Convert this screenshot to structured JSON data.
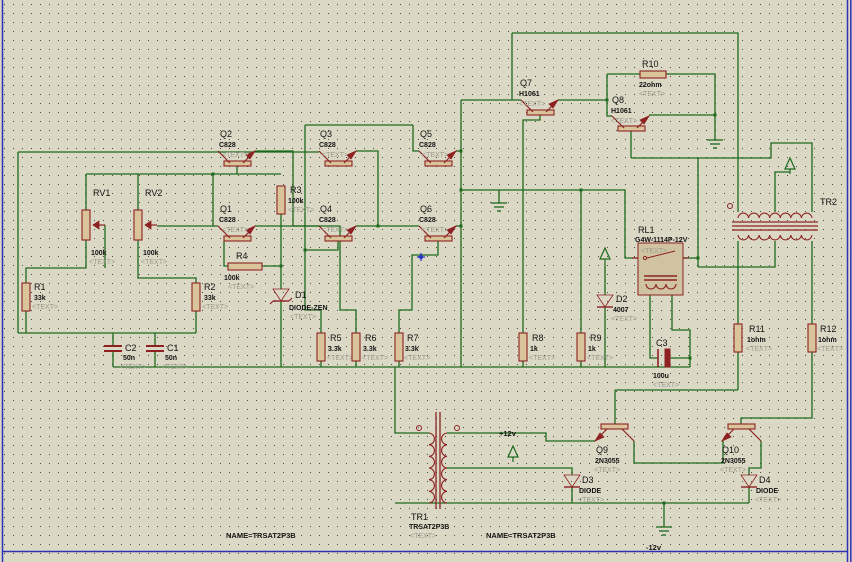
{
  "app": {
    "title": "ISIS Schematic Capture - inverter circuit sheet"
  },
  "canvas": {
    "width": 852,
    "height": 562,
    "bg_color": "#dbd8c6",
    "dot_color": "#4a493c",
    "border_color": "#3030b4",
    "wire_color": "#1d6a1d",
    "part_color": "#8e2222",
    "part_fill": "#d9c49c",
    "relay_fill": "#cfc3a2",
    "placeholder_color": "#9b9b8d"
  },
  "components": [
    {
      "type": "res_v",
      "ref": "R1",
      "value": "33k",
      "extra": "<TEXT>",
      "x": 26,
      "y": 283,
      "label_pos": [
        [
          34,
          290
        ],
        [
          34,
          300
        ],
        [
          32,
          309
        ]
      ]
    },
    {
      "type": "res_v",
      "ref": "R2",
      "value": "33k",
      "extra": "<TEXT>",
      "x": 196,
      "y": 283,
      "label_pos": [
        [
          204,
          290
        ],
        [
          204,
          300
        ],
        [
          202,
          309
        ]
      ]
    },
    {
      "type": "res_v",
      "ref": "R3",
      "value": "100k",
      "extra": "<TEXT>",
      "x": 281,
      "y": 186,
      "label_pos": [
        [
          290,
          193
        ],
        [
          288,
          203
        ],
        [
          288,
          212
        ]
      ]
    },
    {
      "type": "res_h",
      "ref": "R4",
      "value": "100k",
      "extra": "<TEXT>",
      "x": 228,
      "y": 263,
      "w": 34,
      "label_pos": [
        [
          236,
          259
        ],
        [
          224,
          280
        ],
        [
          228,
          289
        ]
      ]
    },
    {
      "type": "res_v",
      "ref": "R5",
      "value": "3.3k",
      "extra": "<TEXT>",
      "x": 321,
      "y": 333,
      "label_pos": [
        [
          330,
          341
        ],
        [
          328,
          351
        ],
        [
          327,
          360
        ]
      ]
    },
    {
      "type": "res_v",
      "ref": "R6",
      "value": "3.3k",
      "extra": "<TEXT>",
      "x": 356,
      "y": 333,
      "label_pos": [
        [
          365,
          341
        ],
        [
          363,
          351
        ],
        [
          362,
          360
        ]
      ]
    },
    {
      "type": "res_v",
      "ref": "R7",
      "value": "3.3k",
      "extra": "<TEXT>",
      "x": 399,
      "y": 333,
      "label_pos": [
        [
          407,
          341
        ],
        [
          405,
          351
        ],
        [
          404,
          360
        ]
      ]
    },
    {
      "type": "res_v",
      "ref": "R8",
      "value": "1k",
      "extra": "<TEXT>",
      "x": 523,
      "y": 333,
      "label_pos": [
        [
          532,
          341
        ],
        [
          530,
          351
        ],
        [
          529,
          360
        ]
      ]
    },
    {
      "type": "res_v",
      "ref": "R9",
      "value": "1k",
      "extra": "<TEXT>",
      "x": 581,
      "y": 333,
      "label_pos": [
        [
          590,
          341
        ],
        [
          588,
          351
        ],
        [
          587,
          360
        ]
      ]
    },
    {
      "type": "res_h",
      "ref": "R10",
      "value": "22ohm",
      "extra": "<TEXT>",
      "x": 640,
      "y": 71,
      "w": 26,
      "label_pos": [
        [
          642,
          67
        ],
        [
          639,
          87
        ],
        [
          639,
          96
        ]
      ]
    },
    {
      "type": "res_v",
      "ref": "R11",
      "value": "1ohm",
      "extra": "<TEXT>",
      "x": 738,
      "y": 324,
      "label_pos": [
        [
          749,
          332
        ],
        [
          747,
          342
        ],
        [
          746,
          351
        ]
      ]
    },
    {
      "type": "res_v",
      "ref": "R12",
      "value": "1ohm",
      "extra": "<TEXT>",
      "x": 812,
      "y": 324,
      "label_pos": [
        [
          820,
          332
        ],
        [
          818,
          342
        ],
        [
          817,
          351
        ]
      ]
    },
    {
      "type": "pot",
      "ref": "RV1",
      "value": "100k",
      "extra": "<TEXT>",
      "x": 86,
      "y": 210,
      "label_pos": [
        [
          93,
          196
        ],
        [
          91,
          255
        ],
        [
          89,
          264
        ]
      ]
    },
    {
      "type": "pot",
      "ref": "RV2",
      "value": "100k",
      "extra": "<TEXT>",
      "x": 138,
      "y": 210,
      "label_pos": [
        [
          145,
          196
        ],
        [
          143,
          255
        ],
        [
          141,
          264
        ]
      ]
    },
    {
      "type": "cap",
      "ref": "C2",
      "value": "50n",
      "extra": "<TEXT>",
      "x": 113,
      "y": 346,
      "label_pos": [
        [
          125,
          351
        ],
        [
          123,
          360
        ],
        [
          120,
          369
        ]
      ]
    },
    {
      "type": "cap",
      "ref": "C1",
      "value": "50n",
      "extra": "<TEXT>",
      "x": 155,
      "y": 346,
      "label_pos": [
        [
          167,
          351
        ],
        [
          165,
          360
        ],
        [
          162,
          369
        ]
      ]
    },
    {
      "type": "cap_pol",
      "ref": "C3",
      "value": "100u",
      "extra": "<TEXT>",
      "x": 664,
      "y": 358,
      "label_pos": [
        [
          656,
          346
        ],
        [
          653,
          378
        ],
        [
          653,
          387
        ]
      ]
    },
    {
      "type": "zener",
      "ref": "D1",
      "value": "DIODE-ZEN",
      "extra": "<TEXT>",
      "x": 281,
      "y": 289,
      "label_pos": [
        [
          295,
          298
        ],
        [
          289,
          310
        ],
        [
          290,
          319
        ]
      ]
    },
    {
      "type": "diode",
      "ref": "D2",
      "value": "4007",
      "extra": "<TEXT>",
      "x": 605,
      "y": 295,
      "label_pos": [
        [
          616,
          302
        ],
        [
          613,
          312
        ],
        [
          611,
          321
        ]
      ]
    },
    {
      "type": "diode",
      "ref": "D3",
      "value": "DIODE",
      "extra": "<TEXT>",
      "x": 572,
      "y": 475,
      "label_pos": [
        [
          582,
          483
        ],
        [
          579,
          493
        ],
        [
          578,
          502
        ]
      ]
    },
    {
      "type": "diode",
      "ref": "D4",
      "value": "DIODE",
      "extra": "<TEXT>",
      "x": 749,
      "y": 475,
      "label_pos": [
        [
          759,
          483
        ],
        [
          756,
          493
        ],
        [
          755,
          502
        ]
      ]
    },
    {
      "type": "npn_up",
      "ref": "Q1",
      "value": "C828",
      "extra": "<TEXT>",
      "x": 224,
      "y": 236,
      "label_pos": [
        [
          220,
          212
        ],
        [
          219,
          222
        ],
        [
          222,
          232
        ]
      ]
    },
    {
      "type": "npn_up",
      "ref": "Q2",
      "value": "C828",
      "extra": "<TEXT>",
      "x": 224,
      "y": 161,
      "label_pos": [
        [
          220,
          137
        ],
        [
          219,
          147
        ],
        [
          222,
          157
        ]
      ]
    },
    {
      "type": "npn_up",
      "ref": "Q3",
      "value": "C828",
      "extra": "<TEXT>",
      "x": 325,
      "y": 161,
      "label_pos": [
        [
          320,
          137
        ],
        [
          319,
          147
        ],
        [
          322,
          157
        ]
      ]
    },
    {
      "type": "npn_up",
      "ref": "Q4",
      "value": "C828",
      "extra": "<TEXT>",
      "x": 325,
      "y": 236,
      "label_pos": [
        [
          320,
          212
        ],
        [
          319,
          222
        ],
        [
          322,
          232
        ]
      ]
    },
    {
      "type": "npn_up",
      "ref": "Q5",
      "value": "C828",
      "extra": "<TEXT>",
      "x": 425,
      "y": 161,
      "label_pos": [
        [
          420,
          137
        ],
        [
          419,
          147
        ],
        [
          422,
          157
        ]
      ]
    },
    {
      "type": "npn_up",
      "ref": "Q6",
      "value": "C828",
      "extra": "<TEXT>",
      "x": 425,
      "y": 236,
      "label_pos": [
        [
          420,
          212
        ],
        [
          419,
          222
        ],
        [
          422,
          232
        ]
      ]
    },
    {
      "type": "npn_up",
      "ref": "Q7",
      "value": "H1061",
      "extra": "<TEXT>",
      "x": 527,
      "y": 110,
      "label_pos": [
        [
          520,
          86
        ],
        [
          519,
          96
        ],
        [
          519,
          106
        ]
      ]
    },
    {
      "type": "npn_up",
      "ref": "Q8",
      "value": "H1061",
      "extra": "<TEXT>",
      "x": 618,
      "y": 126,
      "label_pos": [
        [
          612,
          103
        ],
        [
          611,
          113
        ],
        [
          611,
          123
        ]
      ]
    },
    {
      "type": "npn_down",
      "ref": "Q9",
      "value": "2N3055",
      "extra": "<TEXT>",
      "x": 601,
      "y": 424,
      "label_pos": [
        [
          596,
          453
        ],
        [
          595,
          463
        ],
        [
          594,
          472
        ]
      ]
    },
    {
      "type": "npn_down",
      "ref": "Q10",
      "value": "2N3055",
      "extra": "<TEXT>",
      "x": 728,
      "y": 424,
      "label_pos": [
        [
          722,
          453
        ],
        [
          721,
          463
        ],
        [
          720,
          472
        ]
      ]
    },
    {
      "type": "relay",
      "ref": "RL1",
      "value": "G4W-1114P-12V",
      "extra": "<TEXT>",
      "x": 638,
      "y": 243,
      "label_pos": [
        [
          638,
          233
        ],
        [
          635,
          242
        ],
        [
          641,
          253
        ]
      ]
    },
    {
      "type": "tr_v",
      "ref": "TR1",
      "value": "TRSAT2P3B",
      "extra": "<TEXT>",
      "x": 428,
      "y": 433,
      "label_pos": [
        [
          411,
          520
        ],
        [
          409,
          529
        ],
        [
          410,
          538
        ]
      ]
    },
    {
      "type": "tr_h",
      "ref": "TR2",
      "x": 738,
      "y": 205,
      "label_pos": [
        [
          820,
          205
        ]
      ]
    }
  ],
  "wires": [
    [
      18,
      152,
      319,
      152
    ],
    [
      18,
      152,
      18,
      333
    ],
    [
      18,
      333,
      196,
      333
    ],
    [
      86,
      240,
      86,
      268,
      26,
      268,
      26,
      283
    ],
    [
      26,
      311,
      26,
      333
    ],
    [
      86,
      174,
      281,
      174
    ],
    [
      86,
      174,
      86,
      210
    ],
    [
      138,
      174,
      138,
      210
    ],
    [
      138,
      240,
      138,
      278,
      196,
      278,
      196,
      283
    ],
    [
      196,
      311,
      196,
      333
    ],
    [
      213,
      174,
      213,
      226
    ],
    [
      157,
      226,
      218,
      226
    ],
    [
      105,
      225,
      105,
      268
    ],
    [
      237,
      166,
      237,
      174
    ],
    [
      255,
      226,
      340,
      226,
      340,
      310,
      356,
      310,
      356,
      333
    ],
    [
      255,
      151,
      293,
      151,
      293,
      226,
      319,
      226
    ],
    [
      356,
      151,
      378,
      151,
      378,
      226
    ],
    [
      356,
      226,
      378,
      226
    ],
    [
      378,
      226,
      419,
      226
    ],
    [
      413,
      125,
      413,
      151,
      419,
      151
    ],
    [
      305,
      125,
      413,
      125
    ],
    [
      305,
      125,
      305,
      310,
      321,
      310,
      321,
      333
    ],
    [
      338,
      241,
      338,
      250,
      305,
      250
    ],
    [
      456,
      151,
      461,
      151
    ],
    [
      461,
      100,
      461,
      367
    ],
    [
      461,
      190,
      625,
      190,
      625,
      258,
      638,
      258
    ],
    [
      499,
      190,
      499,
      203
    ],
    [
      456,
      226,
      461,
      226
    ],
    [
      438,
      241,
      438,
      255,
      412,
      255,
      412,
      310,
      399,
      310,
      399,
      333
    ],
    [
      461,
      100,
      521,
      100
    ],
    [
      512,
      33,
      512,
      100
    ],
    [
      512,
      33,
      738,
      33,
      738,
      212
    ],
    [
      558,
      100,
      607,
      100
    ],
    [
      607,
      74,
      607,
      116,
      612,
      116
    ],
    [
      607,
      74,
      640,
      74
    ],
    [
      666,
      74,
      715,
      74,
      715,
      140
    ],
    [
      540,
      115,
      540,
      120,
      523,
      120,
      523,
      333
    ],
    [
      649,
      115,
      715,
      115
    ],
    [
      631,
      131,
      631,
      158
    ],
    [
      631,
      158,
      771,
      158,
      771,
      143,
      812,
      143,
      812,
      212
    ],
    [
      698,
      158,
      698,
      267
    ],
    [
      683,
      258,
      698,
      258
    ],
    [
      698,
      267,
      775,
      267,
      775,
      241
    ],
    [
      775,
      212,
      775,
      172,
      790,
      172
    ],
    [
      605,
      264,
      605,
      295
    ],
    [
      605,
      307,
      605,
      367
    ],
    [
      650,
      295,
      650,
      358,
      658,
      358
    ],
    [
      672,
      295,
      672,
      330,
      690,
      330,
      690,
      367
    ],
    [
      670,
      358,
      690,
      358
    ],
    [
      113,
      367,
      690,
      367
    ],
    [
      113,
      352,
      113,
      367
    ],
    [
      155,
      352,
      155,
      367
    ],
    [
      113,
      333,
      113,
      346
    ],
    [
      155,
      333,
      155,
      346
    ],
    [
      321,
      361,
      321,
      367
    ],
    [
      356,
      361,
      356,
      367
    ],
    [
      399,
      361,
      399,
      367
    ],
    [
      523,
      361,
      523,
      367
    ],
    [
      581,
      361,
      581,
      367
    ],
    [
      581,
      190,
      581,
      333
    ],
    [
      281,
      212,
      281,
      289
    ],
    [
      262,
      266,
      281,
      266
    ],
    [
      281,
      301,
      281,
      367
    ],
    [
      224,
      241,
      224,
      266,
      228,
      266
    ],
    [
      395,
      367,
      395,
      433,
      429,
      433
    ],
    [
      395,
      503,
      749,
      503
    ],
    [
      447,
      433,
      546,
      433,
      546,
      441,
      595,
      441
    ],
    [
      447,
      468,
      572,
      468,
      572,
      475
    ],
    [
      572,
      487,
      572,
      503
    ],
    [
      615,
      390,
      615,
      424
    ],
    [
      615,
      390,
      738,
      390
    ],
    [
      738,
      352,
      738,
      390
    ],
    [
      634,
      441,
      634,
      463,
      723,
      463,
      723,
      441
    ],
    [
      761,
      441,
      761,
      468,
      749,
      468,
      749,
      475
    ],
    [
      749,
      487,
      749,
      503
    ],
    [
      664,
      503,
      664,
      527
    ],
    [
      812,
      352,
      812,
      418,
      741,
      418,
      741,
      424
    ],
    [
      738,
      241,
      738,
      324
    ],
    [
      812,
      241,
      812,
      324
    ]
  ],
  "junctions": [
    [
      213,
      174
    ],
    [
      305,
      250
    ],
    [
      378,
      226
    ],
    [
      461,
      151
    ],
    [
      461,
      190
    ],
    [
      461,
      226
    ],
    [
      581,
      190
    ],
    [
      607,
      100
    ],
    [
      715,
      115
    ],
    [
      281,
      266
    ],
    [
      698,
      258
    ],
    [
      690,
      358
    ],
    [
      664,
      503
    ]
  ],
  "grounds": [
    {
      "x": 499,
      "y": 203
    },
    {
      "x": 715,
      "y": 140
    },
    {
      "x": 664,
      "y": 527
    }
  ],
  "power_flags": [
    {
      "x": 605,
      "y": 248
    },
    {
      "x": 790,
      "y": 158
    },
    {
      "x": 513,
      "y": 446
    }
  ],
  "annotations": [
    {
      "text": "+12v",
      "x": 499,
      "y": 436
    },
    {
      "text": "-12v",
      "x": 646,
      "y": 550
    },
    {
      "text": "NAME=TRSAT2P3B",
      "x": 226,
      "y": 538
    },
    {
      "text": "NAME=TRSAT2P3B",
      "x": 486,
      "y": 538
    }
  ],
  "markers": [
    {
      "x": 421,
      "y": 257,
      "color": "#2233cc"
    }
  ]
}
